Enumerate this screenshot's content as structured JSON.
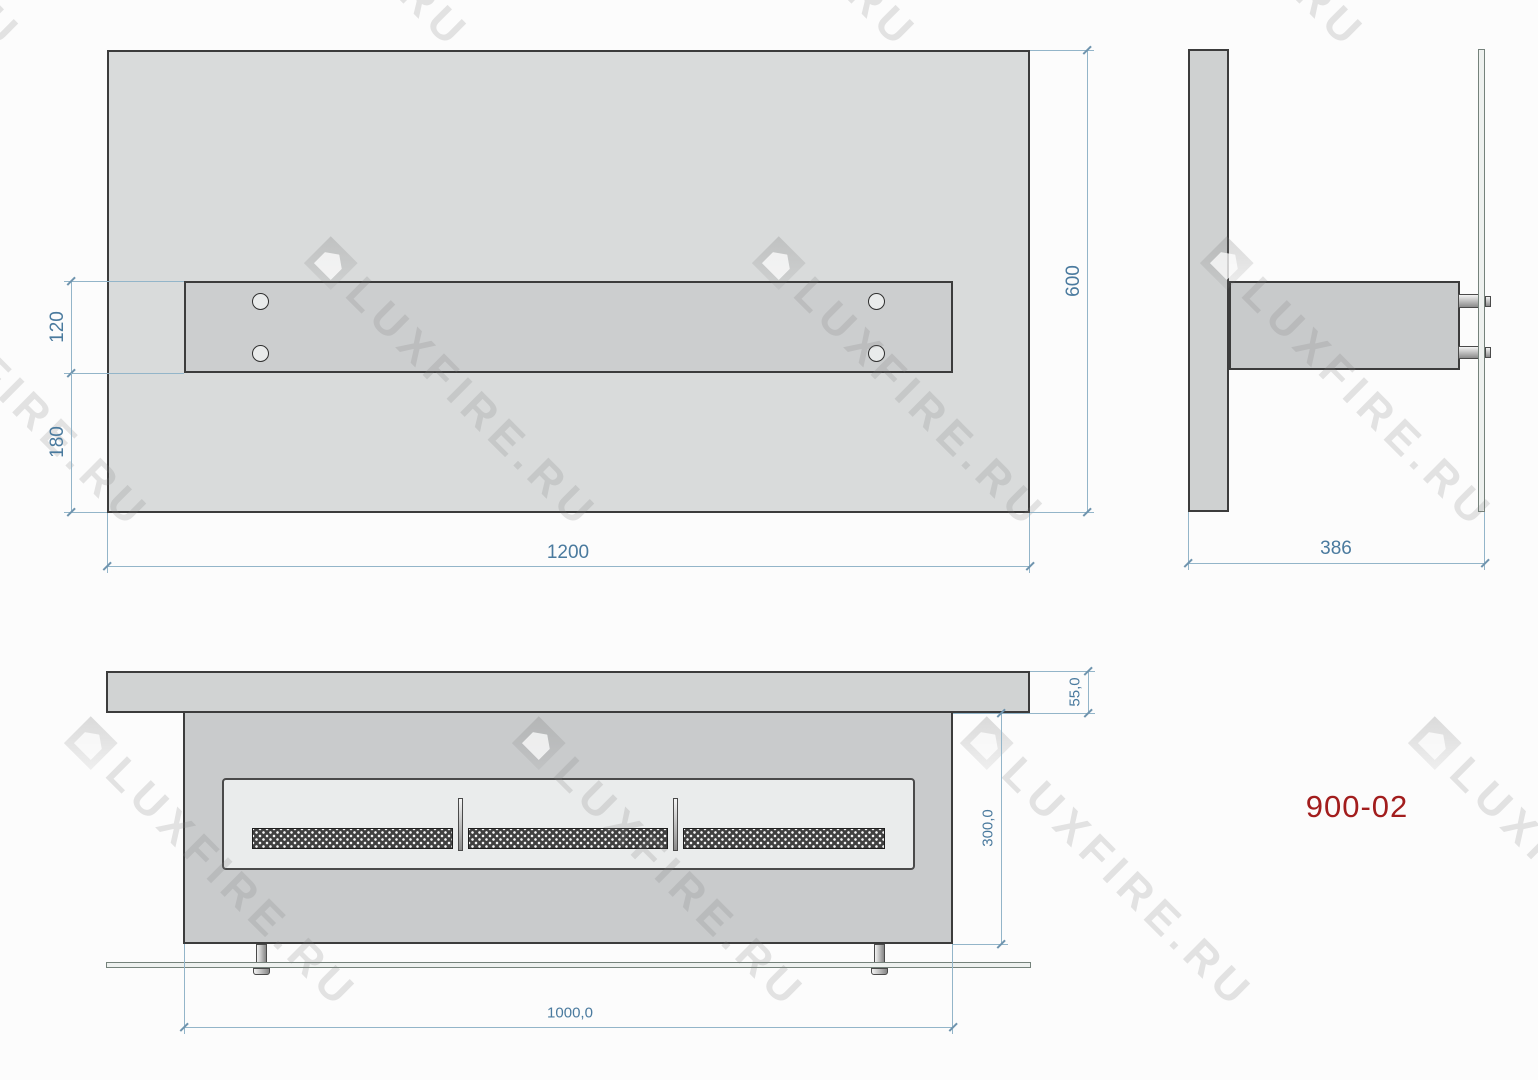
{
  "watermark": {
    "text": "LUXFIRE.RU"
  },
  "model_label": "900-02",
  "colors": {
    "dimension_text": "#4a7a9e",
    "dimension_line": "#93b5c9",
    "model_label_red": "#a21d1d"
  },
  "plan_view": {
    "dim_width": "1200",
    "dim_height": "600",
    "dim_bar_width": "120",
    "dim_bar_offset": "180"
  },
  "side_view": {
    "dim_depth": "386"
  },
  "front_view": {
    "dim_shelf_thickness": "55,0",
    "dim_body_height": "300,0",
    "dim_body_width": "1000,0"
  }
}
